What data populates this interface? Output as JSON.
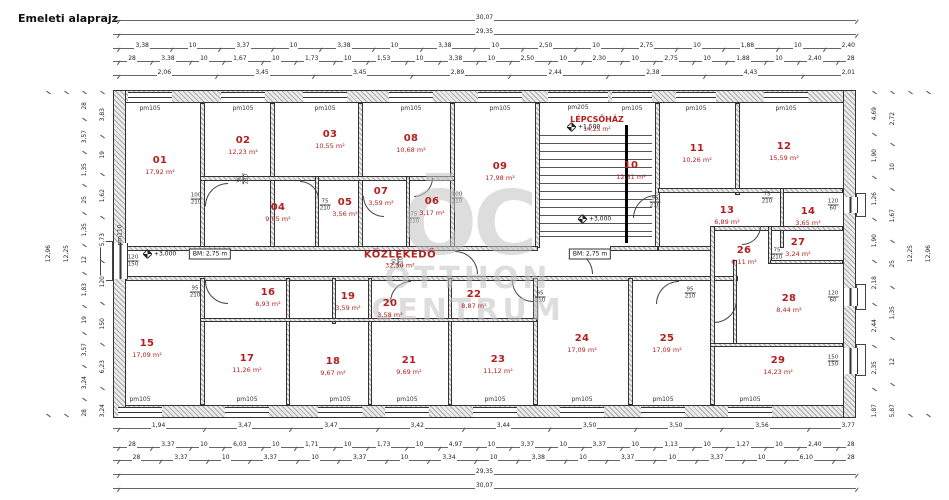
{
  "title": "Emeleti alaprajz",
  "watermark": {
    "logo": "ŌC",
    "line1": "OTTHON",
    "line2": "CENTRUM"
  },
  "corridor": {
    "name": "KÖZLEKEDŐ",
    "area": "32,50 m²"
  },
  "stairwell": {
    "name": "LÉPCSŐHÁZ",
    "area": "14,25 m²",
    "level_upper": "+1,500",
    "level_lower": "+3,000",
    "window_label": "pm205"
  },
  "markers": {
    "level_left": "+3,000",
    "bm_left": "BM: 2,75 m",
    "bm_right": "BM: 2,75 m"
  },
  "window_labels": {
    "standard": "pm105",
    "left": "pm110"
  },
  "rooms": [
    {
      "number": "01",
      "area": "17,92 m²"
    },
    {
      "number": "02",
      "area": "12,23 m²"
    },
    {
      "number": "03",
      "area": "10,55 m²"
    },
    {
      "number": "04",
      "area": "9,05 m²"
    },
    {
      "number": "05",
      "area": "3,56 m²"
    },
    {
      "number": "06",
      "area": "3,17 m²"
    },
    {
      "number": "07",
      "area": "3,59 m²"
    },
    {
      "number": "08",
      "area": "10,68 m²"
    },
    {
      "number": "09",
      "area": "17,98 m²"
    },
    {
      "number": "10",
      "area": "12,31 m²"
    },
    {
      "number": "11",
      "area": "10,26 m²"
    },
    {
      "number": "12",
      "area": "15,59 m²"
    },
    {
      "number": "13",
      "area": "6,89 m²"
    },
    {
      "number": "14",
      "area": "3,65 m²"
    },
    {
      "number": "15",
      "area": "17,09 m²"
    },
    {
      "number": "16",
      "area": "8,93 m²"
    },
    {
      "number": "17",
      "area": "11,26 m²"
    },
    {
      "number": "18",
      "area": "9,67 m²"
    },
    {
      "number": "19",
      "area": "3,59 m²"
    },
    {
      "number": "20",
      "area": "3,58 m²"
    },
    {
      "number": "21",
      "area": "9,69 m²"
    },
    {
      "number": "22",
      "area": "8,87 m²"
    },
    {
      "number": "23",
      "area": "11,12 m²"
    },
    {
      "number": "24",
      "area": "17,09 m²"
    },
    {
      "number": "25",
      "area": "17,09 m²"
    },
    {
      "number": "26",
      "area": "6,11 m²"
    },
    {
      "number": "27",
      "area": "3,24 m²"
    },
    {
      "number": "28",
      "area": "8,44 m²"
    },
    {
      "number": "29",
      "area": "14,23 m²"
    }
  ],
  "doors": [
    {
      "w": "100",
      "h": "210"
    },
    {
      "w": "90",
      "h": "210"
    },
    {
      "w": "75",
      "h": "210"
    },
    {
      "w": "75",
      "h": "210"
    },
    {
      "w": "100",
      "h": "210"
    },
    {
      "w": "95",
      "h": "210"
    },
    {
      "w": "75",
      "h": "210"
    },
    {
      "w": "95",
      "h": "210"
    },
    {
      "w": "95",
      "h": "210"
    },
    {
      "w": "95",
      "h": "210"
    },
    {
      "w": "90",
      "h": "210"
    },
    {
      "w": "75",
      "h": "210"
    }
  ],
  "right_wall_windows": [
    {
      "w": "120",
      "h": "60"
    },
    {
      "w": "120",
      "h": "60"
    },
    {
      "w": "150",
      "h": "150"
    }
  ],
  "left_wall_window": {
    "w": "120",
    "h": "150"
  },
  "dimensions": {
    "top": [
      {
        "values": [
          "30,07"
        ]
      },
      {
        "values": [
          "29,35"
        ]
      },
      {
        "values": [
          "3,38",
          "10",
          "3,37",
          "10",
          "3,38",
          "10",
          "3,38",
          "10",
          "2,50",
          "10",
          "2,75",
          "10",
          "1,88",
          "10",
          "2,40"
        ]
      },
      {
        "values": [
          "28",
          "3,38",
          "10",
          "1,67",
          "10",
          "1,73",
          "10",
          "1,53",
          "10",
          "3,38",
          "10",
          "2,50",
          "10",
          "2,30",
          "10",
          "2,75",
          "10",
          "1,88",
          "10",
          "2,40",
          "28"
        ]
      },
      {
        "values": [
          "2,06",
          "3,45",
          "3,45",
          "2,89",
          "2,44",
          "2,38",
          "4,43",
          "2,01"
        ]
      }
    ],
    "bottom": [
      {
        "values": [
          "1,94",
          "3,47",
          "3,47",
          "3,42",
          "3,44",
          "3,50",
          "3,50",
          "3,56",
          "3,77"
        ]
      },
      {
        "values": [
          "28",
          "3,37",
          "10",
          "6,03",
          "10",
          "1,71",
          "10",
          "1,73",
          "10",
          "4,97",
          "10",
          "3,37",
          "10",
          "3,37",
          "10",
          "1,13",
          "10",
          "1,27",
          "10",
          "2,40",
          "28"
        ]
      },
      {
        "values": [
          "28",
          "3,37",
          "10",
          "3,37",
          "10",
          "3,37",
          "10",
          "3,34",
          "10",
          "3,38",
          "10",
          "3,37",
          "10",
          "3,37",
          "10",
          "6,10",
          "28"
        ]
      },
      {
        "values": [
          "29,35"
        ]
      },
      {
        "values": [
          "30,07"
        ]
      }
    ],
    "left": [
      {
        "values": [
          "12,96"
        ]
      },
      {
        "values": [
          "12,25"
        ]
      },
      {
        "values": [
          "28",
          "3,57",
          "1,35",
          "25",
          "1,35",
          "12",
          "1,83",
          "19",
          "3,57",
          "3,24",
          "28"
        ]
      },
      {
        "values": [
          "3,83",
          "19",
          "1,62",
          "5,73",
          "120",
          "150",
          "6,23",
          "3,24"
        ]
      }
    ],
    "right": [
      {
        "values": [
          "4,69",
          "1,90",
          "1,26",
          "1,90",
          "2,18",
          "2,44",
          "2,35",
          "1,87"
        ]
      },
      {
        "values": [
          "2,72",
          "10",
          "1,67",
          "25",
          "1,35",
          "12",
          "5,87"
        ]
      },
      {
        "values": [
          "12,25"
        ]
      },
      {
        "values": [
          "12,96"
        ]
      }
    ]
  }
}
